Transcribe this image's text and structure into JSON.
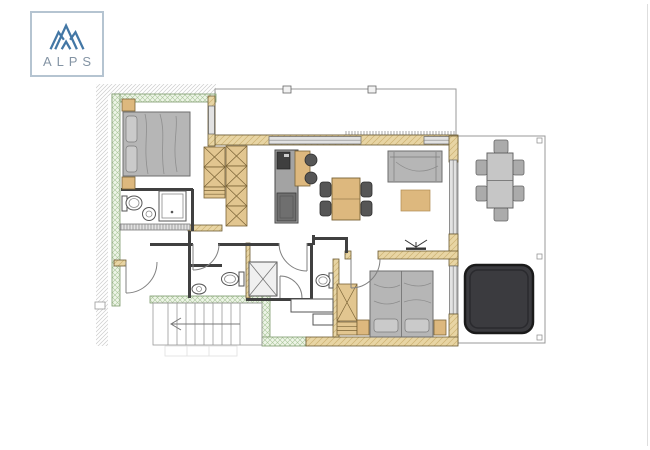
{
  "logo": {
    "text": "ALPS",
    "icon": "mountain-peaks-icon"
  },
  "colors": {
    "pageBg": "#ffffff",
    "logoBorder": "#b5c4d1",
    "logoBlue": "#4377a5",
    "logoText": "#8494a4",
    "hatchLine": "#cccccc",
    "greenFill": "#eef4e7",
    "greenLine": "#a9c79a",
    "greenStroke": "#7d9a6d",
    "wallTan": "#e8d5a4",
    "wallTanLine": "#cdb273",
    "wallStroke": "#6b5b33",
    "interiorWall": "#404040",
    "balconyLine": "#d6d6d6",
    "deckLine": "#e3e3e3",
    "outlineGray": "#999999",
    "glass": "#e2e2e2",
    "glassStroke": "#666666",
    "furnGray": "#b6b6b6",
    "furnGrayLight": "#cacaca",
    "furnStroke": "#6e6e6e",
    "furnTan": "#ddb87e",
    "furnTanStroke": "#7a6336",
    "counterGray": "#a3a3a3",
    "sinkDark": "#3f3f3f",
    "applianceGray": "#6f6f6f",
    "chairDark": "#565656",
    "outdoorGray": "#c6c6c6",
    "outdoorChair": "#ababab",
    "hotTub": "#3b3b3f",
    "hotTubStroke": "#1a1a1a",
    "stairLine": "#9a9a9a",
    "doorStroke": "#808080",
    "fixtureStroke": "#555555",
    "edgeLine": "#dedede"
  },
  "floor_plan": {
    "type": "apartment-floor-plan",
    "rooms": [
      "bedroom-1",
      "en-suite-bathroom",
      "hallway",
      "wc",
      "shower-room",
      "bathroom-2",
      "kitchen",
      "living-dining-room",
      "bedroom-2",
      "staircase",
      "storage",
      "terrace",
      "balcony-overhang"
    ],
    "furniture": [
      "double-bed-1",
      "nightstand",
      "wardrobe-closets",
      "shower",
      "toilet",
      "washbasin",
      "kitchen-counter",
      "kitchen-bar",
      "bar-stools",
      "dining-table",
      "dining-chairs",
      "sofa",
      "rug",
      "double-bed-2",
      "outdoor-dining-table",
      "outdoor-chairs",
      "hot-tub"
    ],
    "icons": [
      "mountain-peaks-icon",
      "ceiling-fan-icon",
      "stairs-direction-arrow"
    ]
  }
}
